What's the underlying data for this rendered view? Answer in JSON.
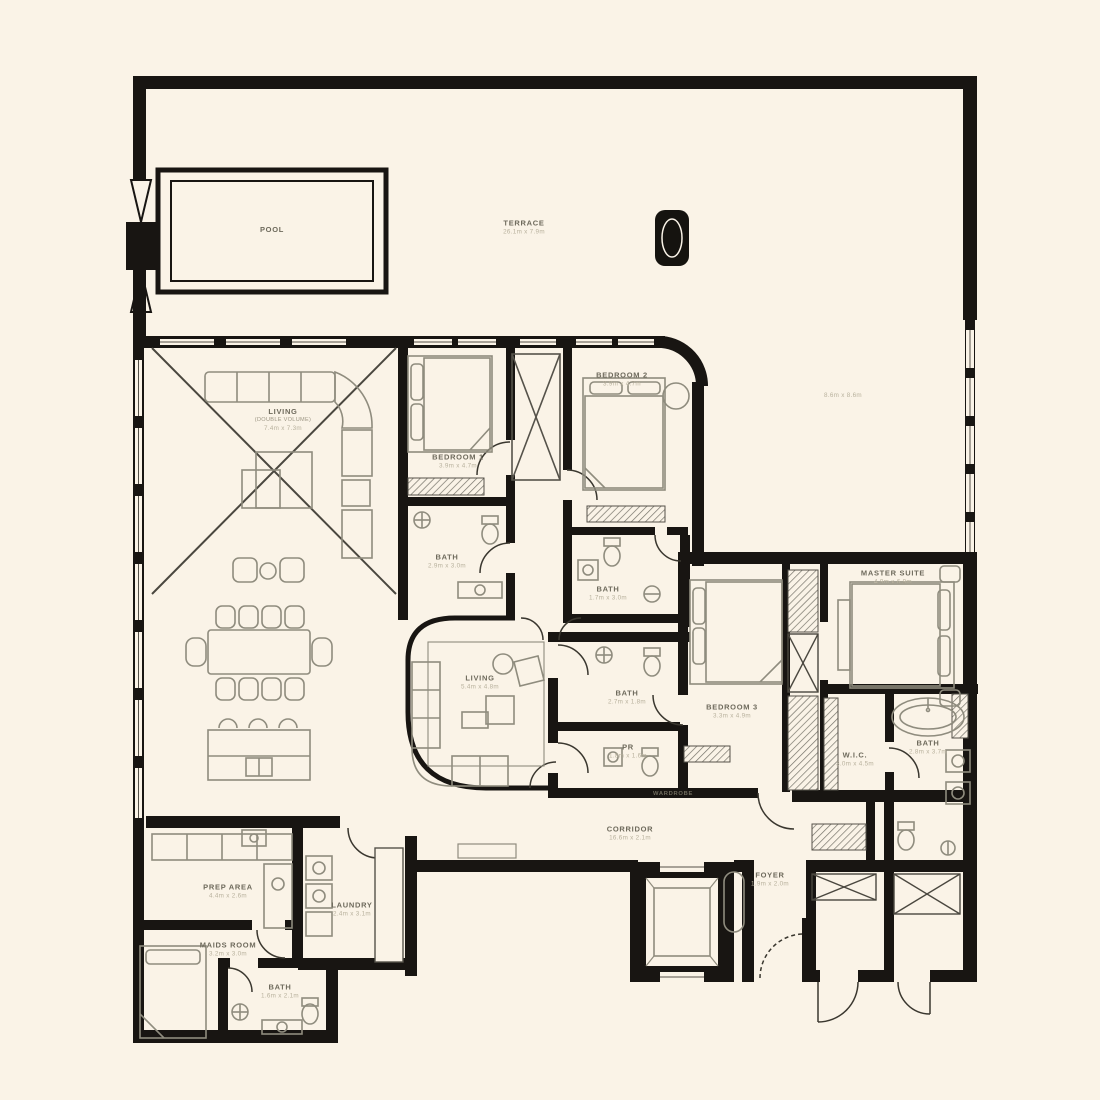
{
  "meta": {
    "background_color": "#faf3e7",
    "wall_color": "#181512",
    "furniture_color": "#8f8c7e",
    "label_color": "#6e6a5c",
    "dims_color": "#b8b19d"
  },
  "rooms": {
    "pool": {
      "name": "POOL",
      "dims": ""
    },
    "terrace": {
      "name": "TERRACE",
      "dims": "26.1m x 7.9m"
    },
    "terraceSide": {
      "name": "",
      "dims": "8.6m x 8.6m"
    },
    "livingMain": {
      "name": "LIVING",
      "sub": "(DOUBLE VOLUME)",
      "dims": "7.4m x 7.3m"
    },
    "bedroom1": {
      "name": "BEDROOM 1",
      "dims": "3.9m x 4.7m"
    },
    "bath1": {
      "name": "BATH",
      "dims": "2.9m x 3.0m"
    },
    "bedroom2": {
      "name": "BEDROOM 2",
      "dims": "3.9m x 4.7m"
    },
    "bath2": {
      "name": "BATH",
      "dims": "1.7m x 3.0m"
    },
    "livingFamily": {
      "name": "LIVING",
      "dims": "5.4m x 4.8m"
    },
    "bath3": {
      "name": "BATH",
      "dims": "2.7m x 1.8m"
    },
    "pr": {
      "name": "PR",
      "dims": "1.8m x 1.6m"
    },
    "bedroom3": {
      "name": "BEDROOM 3",
      "dims": "3.3m x 4.9m"
    },
    "wardrobe": {
      "name": "WARDROBE",
      "dims": ""
    },
    "master": {
      "name": "MASTER SUITE",
      "dims": "4.9m x 6.9m"
    },
    "wic": {
      "name": "W.I.C.",
      "dims": "3.0m x 4.5m"
    },
    "bathMaster": {
      "name": "BATH",
      "dims": "2.8m x 3.7m"
    },
    "corridor": {
      "name": "CORRIDOR",
      "dims": "16.6m x 2.1m"
    },
    "foyer": {
      "name": "FOYER",
      "dims": "1.9m x 2.0m"
    },
    "prep": {
      "name": "PREP AREA",
      "dims": "4.4m x 2.6m"
    },
    "laundry": {
      "name": "LAUNDRY",
      "dims": "2.4m x 3.1m"
    },
    "maids": {
      "name": "MAIDS ROOM",
      "dims": "3.2m x 3.0m"
    },
    "bathMaids": {
      "name": "BATH",
      "dims": "1.6m x 2.1m"
    }
  }
}
